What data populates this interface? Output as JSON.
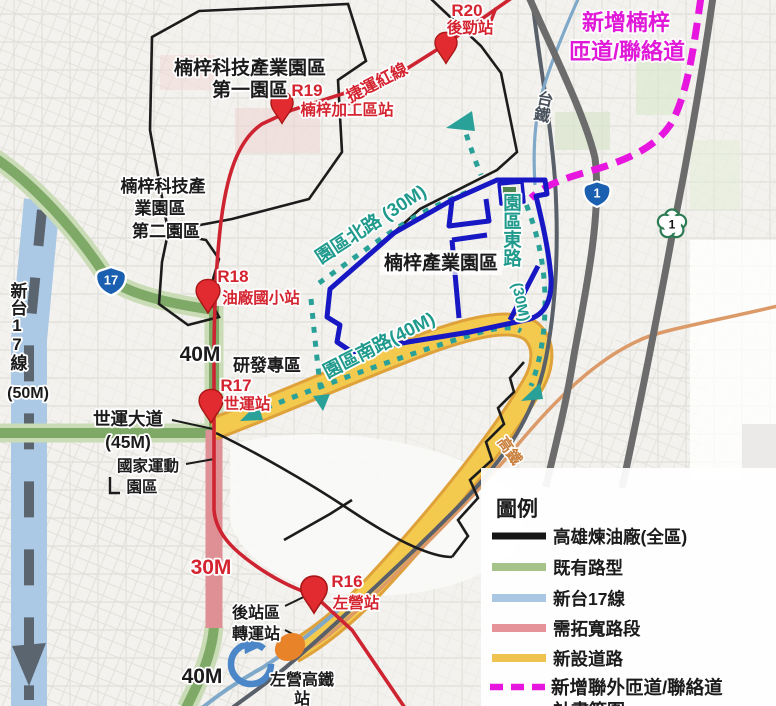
{
  "colors": {
    "green_halo": "#c9dcb6",
    "green_core": "#7fa966",
    "widen_pink": "#de9095",
    "yellow_edge": "#dfa23b",
    "yellow_core": "#f3ca4e",
    "mrt_red": "#ce2431",
    "industrial_blue": "#1717c4",
    "flow_teal": "#2aa198",
    "ramp_magenta": "#e716df",
    "boundary_black": "#1c1c1c",
    "railway_gray": "#59606a",
    "highway_gray": "#6c6c6c",
    "hsr_orange": "#dc9a68",
    "tai17_band_blue": "#abc8e4",
    "tai17_dash_gray": "#5b6570",
    "coastal_blue_line": "#7fa8c9",
    "roundabout_blue": "#4a86c8",
    "hsr_node_orange": "#e8832a",
    "pin_red": "#e22b30",
    "shield_blue": "#1b5fb0",
    "plum_green": "#2c7a52",
    "label_teal": "#1f9a8c",
    "label_red": "#d42430",
    "label_black": "#1b1b1b",
    "label_magenta": "#e018d8",
    "label_orange": "#c9803c",
    "label_rail_gray": "#49525c"
  },
  "areas": {
    "park1_line1": "楠梓科技產業園區",
    "park1_line2": "第一園區",
    "park2_line1": "楠梓科技產",
    "park2_line2": "業園區",
    "park2_line3": "第二園區",
    "industrial_park": "楠梓產業園區",
    "rd_zone": "研發專區",
    "national_sports_line1": "國家運動",
    "national_sports_line2": "園區",
    "backstation_line1": "後站區",
    "backstation_line2": "轉運站",
    "hsr_station_line1": "左營高鐵",
    "hsr_station_line2": "站"
  },
  "stations": [
    {
      "code": "R20",
      "name": "後勁站"
    },
    {
      "code": "R19",
      "name": "楠梓加工區站"
    },
    {
      "code": "R18",
      "name": "油廠國小站"
    },
    {
      "code": "R17",
      "name": "世運站"
    },
    {
      "code": "R16",
      "name": "左營站"
    }
  ],
  "roads": {
    "mrt_line_label": "捷運紅線",
    "north_rd": "園區北路 (30M)",
    "east_rd_name": "園區東路",
    "east_rd_width": "(30M)",
    "south_rd": "園區南路(40M)",
    "sports_blvd": "世運大道",
    "sports_blvd_width": "(45M)",
    "tra_label": "台鐵",
    "hsr_label": "高鐵",
    "new_ramp_line1": "新增楠梓",
    "new_ramp_line2": "匝道/聯絡道",
    "tai17_label": "新台17線",
    "tai17_width": "(50M)",
    "width_40m_top": "40M",
    "width_30m": "30M",
    "width_40m_bottom": "40M"
  },
  "shields": {
    "provincial_17": "17",
    "provincial_1": "1",
    "freeway_1": "1"
  },
  "legend": {
    "title": "圖例",
    "items": [
      {
        "label": "高雄煉油廠(全區)",
        "color": "#151515",
        "style": "solid"
      },
      {
        "label": "既有路型",
        "color": "#a6c48a",
        "style": "solid"
      },
      {
        "label": "新台17線",
        "color": "#a9c7e3",
        "style": "solid"
      },
      {
        "label": "需拓寬路段",
        "color": "#e59398",
        "style": "solid"
      },
      {
        "label": "新設道路",
        "color": "#f0c24f",
        "style": "solid"
      },
      {
        "label": "新增聯外匝道/聯絡道",
        "color": "#e716df",
        "style": "dashed"
      },
      {
        "label": "計畫範圍",
        "color": "#9a9a9a",
        "style": "solid"
      }
    ]
  }
}
